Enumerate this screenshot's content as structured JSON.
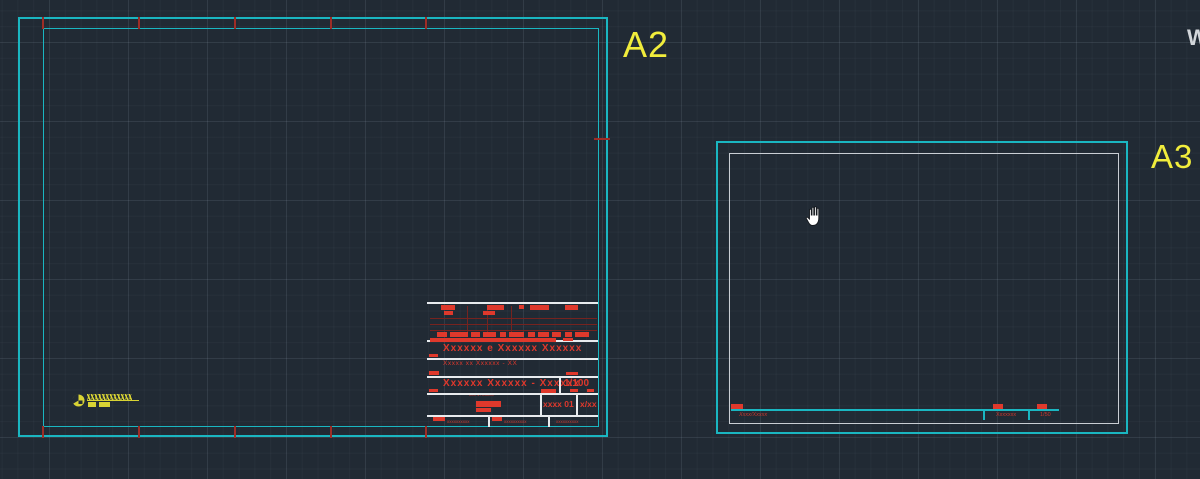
{
  "colors": {
    "background": "#212a34",
    "frame_cyan": "#1ab6c1",
    "frame_gray": "#c9ced4",
    "label_yellow": "#f1ed3c",
    "annotation_red": "#df382c",
    "titleblock_white": "#e8ebee",
    "logo_yellow": "#d8d334"
  },
  "sheets": {
    "a2": {
      "label": "A2",
      "titleblock": {
        "project_title": "Xxxxxx e Xxxxxx Xxxxxx",
        "subtitle": "Xxxxx xx Xxxxxx - XX",
        "drawing_title": "Xxxxxx Xxxxxx - Xxxxxx",
        "scale": "1/100",
        "micro_note": "xxx 1TLxxxx",
        "sheet_code": "xxxx 01",
        "page_no": "x/xx",
        "footer_cells": [
          "xxxxxxxxxx",
          "xxxxxxxxxx",
          "xxxxxxxxxx"
        ]
      }
    },
    "a3": {
      "label": "A3",
      "strip": {
        "left_note": "Xxxx/Xxxxx",
        "center_note": "Xxxxxxx",
        "scale": "1/50"
      }
    }
  },
  "overlay": {
    "viewcube_letter": "W"
  }
}
